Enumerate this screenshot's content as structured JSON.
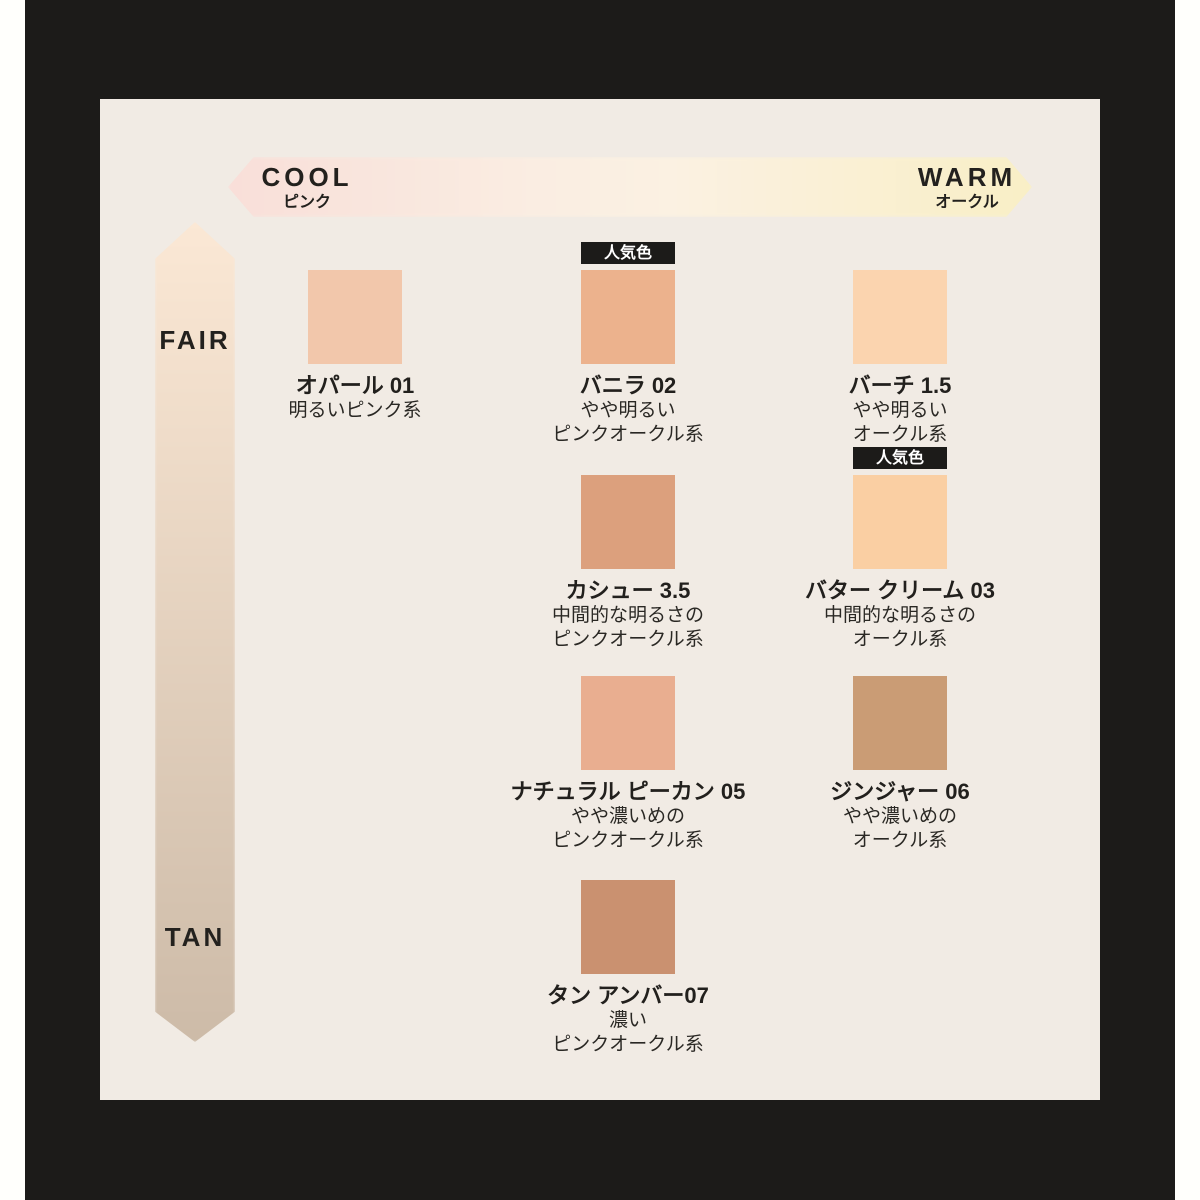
{
  "page": {
    "frame_bg": "#1C1B19",
    "strip_bg": "#FFFFFC",
    "panel_bg": "#F1EBE4"
  },
  "temperature_axis": {
    "cool_label": "COOL",
    "cool_sublabel": "ピンク",
    "warm_label": "WARM",
    "warm_sublabel": "オークル",
    "gradient_left": "#F9DFD9",
    "gradient_right": "#F9EFC6"
  },
  "depth_axis": {
    "top_label": "FAIR",
    "bottom_label": "TAN",
    "gradient_top": "#FBE8D5",
    "gradient_bottom": "#CDBBA8"
  },
  "popular_badge": "人気色",
  "shades": [
    {
      "name": "オパール 01",
      "desc1": "明るいピンク系",
      "desc2": "",
      "color": "#F2C7AB",
      "popular": false
    },
    {
      "name": "バニラ 02",
      "desc1": "やや明るい",
      "desc2": "ピンクオークル系",
      "color": "#ECB28D",
      "popular": true
    },
    {
      "name": "バーチ 1.5",
      "desc1": "やや明るい",
      "desc2": "オークル系",
      "color": "#FBD4AF",
      "popular": false
    },
    {
      "name": "カシュー 3.5",
      "desc1": "中間的な明るさの",
      "desc2": "ピンクオークル系",
      "color": "#DCA07D",
      "popular": false
    },
    {
      "name": "バター クリーム 03",
      "desc1": "中間的な明るさの",
      "desc2": "オークル系",
      "color": "#FACFA3",
      "popular": true
    },
    {
      "name": "ナチュラル ピーカン 05",
      "desc1": "やや濃いめの",
      "desc2": "ピンクオークル系",
      "color": "#E9AE90",
      "popular": false
    },
    {
      "name": "ジンジャー 06",
      "desc1": "やや濃いめの",
      "desc2": "オークル系",
      "color": "#CA9C75",
      "popular": false
    },
    {
      "name": "タン アンバー07",
      "desc1": "濃い",
      "desc2": "ピンクオークル系",
      "color": "#CA9170",
      "popular": false
    }
  ]
}
